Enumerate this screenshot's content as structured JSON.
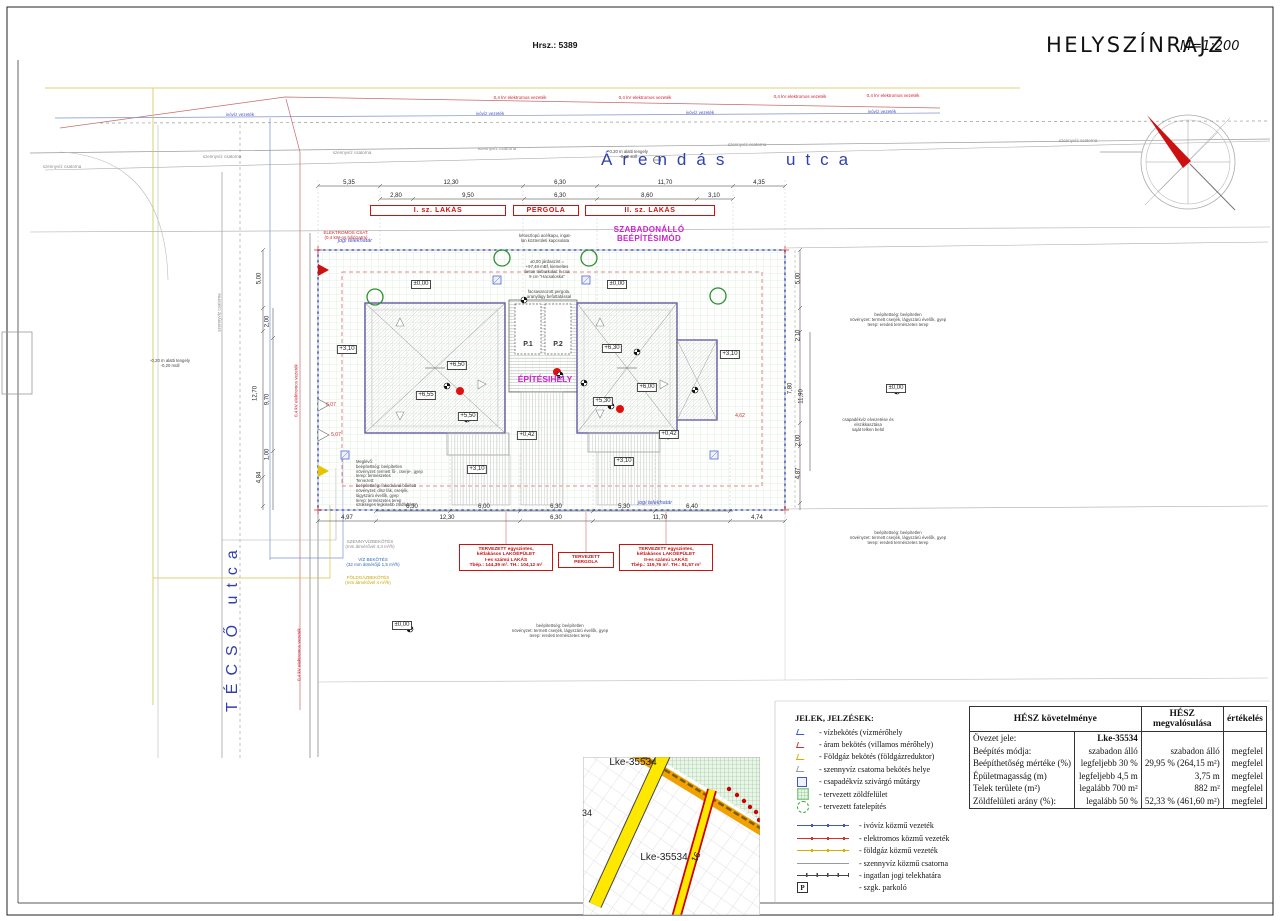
{
  "page": {
    "hrsz": "Hrsz.: 5389",
    "title": "HELYSZÍNRAJZ",
    "scale": "M=1:200"
  },
  "streets": {
    "top_a": "Árendás",
    "top_b": "utca",
    "left": "TÉCSŐ   utca"
  },
  "colors": {
    "red": "#cc2222",
    "magenta": "#cc22cc",
    "street_blue": "#3040ae",
    "boundary_blue": "#5c6cd0",
    "gas_yellow": "#d4af00",
    "green": "#2f8f2f"
  },
  "labels": [
    {
      "t": "5,35",
      "x": 349,
      "y": 180,
      "c": "d"
    },
    {
      "t": "12,30",
      "x": 451,
      "y": 180,
      "c": "d"
    },
    {
      "t": "6,30",
      "x": 560,
      "y": 180,
      "c": "d"
    },
    {
      "t": "11,70",
      "x": 665,
      "y": 180,
      "c": "d"
    },
    {
      "t": "4,35",
      "x": 759,
      "y": 180,
      "c": "d"
    },
    {
      "t": "2,80",
      "x": 396,
      "y": 193,
      "c": "d"
    },
    {
      "t": "9,50",
      "x": 468,
      "y": 193,
      "c": "d"
    },
    {
      "t": "6,30",
      "x": 560,
      "y": 193,
      "c": "d"
    },
    {
      "t": "8,60",
      "x": 647,
      "y": 193,
      "c": "d"
    },
    {
      "t": "3,10",
      "x": 714,
      "y": 193,
      "c": "d"
    },
    {
      "t": "6,30",
      "x": 412,
      "y": 504,
      "c": "d"
    },
    {
      "t": "6,00",
      "x": 484,
      "y": 504,
      "c": "d"
    },
    {
      "t": "6,30",
      "x": 556,
      "y": 504,
      "c": "d"
    },
    {
      "t": "5,30",
      "x": 624,
      "y": 504,
      "c": "d"
    },
    {
      "t": "6,40",
      "x": 692,
      "y": 504,
      "c": "d"
    },
    {
      "t": "4,97",
      "x": 347,
      "y": 515,
      "c": "d"
    },
    {
      "t": "12,30",
      "x": 447,
      "y": 515,
      "c": "d"
    },
    {
      "t": "6,30",
      "x": 556,
      "y": 515,
      "c": "d"
    },
    {
      "t": "11,70",
      "x": 660,
      "y": 515,
      "c": "d"
    },
    {
      "t": "4,74",
      "x": 757,
      "y": 515,
      "c": "d"
    },
    {
      "t": "5,00",
      "x": 260,
      "y": 275,
      "c": "dv",
      "r": -90
    },
    {
      "t": "2,00",
      "x": 268,
      "y": 318,
      "c": "dv",
      "r": -90
    },
    {
      "t": "12,70",
      "x": 256,
      "y": 390,
      "c": "dv",
      "r": -90
    },
    {
      "t": "9,70",
      "x": 268,
      "y": 396,
      "c": "dv",
      "r": -90
    },
    {
      "t": "1,00",
      "x": 268,
      "y": 451,
      "c": "dv",
      "r": -90
    },
    {
      "t": "4,84",
      "x": 260,
      "y": 474,
      "c": "dv",
      "r": -90
    },
    {
      "t": "5,00",
      "x": 799,
      "y": 275,
      "c": "dv",
      "r": -90
    },
    {
      "t": "2,10",
      "x": 799,
      "y": 332,
      "c": "dv",
      "r": -90
    },
    {
      "t": "7,80",
      "x": 791,
      "y": 385,
      "c": "dv",
      "r": -90
    },
    {
      "t": "11,90",
      "x": 802,
      "y": 393,
      "c": "dv",
      "r": -90
    },
    {
      "t": "2,00",
      "x": 799,
      "y": 437,
      "c": "dv",
      "r": -90
    },
    {
      "t": "4,87",
      "x": 799,
      "y": 470,
      "c": "dv",
      "r": -90
    },
    {
      "t": "6,07",
      "x": 331,
      "y": 403,
      "c": "dr"
    },
    {
      "t": "5,07",
      "x": 336,
      "y": 433,
      "c": "dr"
    },
    {
      "t": "4,62",
      "x": 740,
      "y": 414,
      "c": "dr"
    },
    {
      "t": "+3,10",
      "x": 347,
      "y": 345,
      "c": "e"
    },
    {
      "t": "±0,00",
      "x": 421,
      "y": 280,
      "c": "e"
    },
    {
      "t": "+6,50",
      "x": 457,
      "y": 361,
      "c": "e"
    },
    {
      "t": "+6,55",
      "x": 426,
      "y": 391,
      "c": "e"
    },
    {
      "t": "+5,50",
      "x": 468,
      "y": 412,
      "c": "e"
    },
    {
      "t": "+0,42",
      "x": 527,
      "y": 431,
      "c": "e"
    },
    {
      "t": "+3,10",
      "x": 477,
      "y": 465,
      "c": "e"
    },
    {
      "t": "±0,00",
      "x": 617,
      "y": 280,
      "c": "e"
    },
    {
      "t": "+6,30",
      "x": 612,
      "y": 344,
      "c": "e"
    },
    {
      "t": "+6,00",
      "x": 647,
      "y": 383,
      "c": "e"
    },
    {
      "t": "+5,30",
      "x": 603,
      "y": 397,
      "c": "e"
    },
    {
      "t": "+0,42",
      "x": 669,
      "y": 430,
      "c": "e"
    },
    {
      "t": "+3,10",
      "x": 624,
      "y": 457,
      "c": "e"
    },
    {
      "t": "+3,10",
      "x": 730,
      "y": 350,
      "c": "e"
    },
    {
      "t": "±0,00",
      "x": 896,
      "y": 384,
      "c": "e"
    },
    {
      "t": "±0,00",
      "x": 402,
      "y": 621,
      "c": "e"
    },
    {
      "t": "0,4 kV elektromos vezeték",
      "x": 520,
      "y": 95,
      "c": "ur"
    },
    {
      "t": "0,4 kV elektromos vezeték",
      "x": 645,
      "y": 95,
      "c": "ur"
    },
    {
      "t": "0,4 kV elektromos vezeték",
      "x": 800,
      "y": 94,
      "c": "ur"
    },
    {
      "t": "0,4 kV elektromos vezeték",
      "x": 893,
      "y": 93,
      "c": "ur"
    },
    {
      "t": "0,4 kV elektromos vezeték",
      "x": 296,
      "y": 388,
      "c": "ur",
      "r": -90
    },
    {
      "t": "0,4 kV elektromos vezeték",
      "x": 299,
      "y": 652,
      "c": "ur",
      "r": -90
    },
    {
      "t": "ivóvíz vezeték",
      "x": 240,
      "y": 112,
      "c": "ub"
    },
    {
      "t": "ivóvíz vezeték",
      "x": 490,
      "y": 111,
      "c": "ub"
    },
    {
      "t": "ivóvíz vezeték",
      "x": 700,
      "y": 110,
      "c": "ub"
    },
    {
      "t": "ivóvíz vezeték",
      "x": 882,
      "y": 109,
      "c": "ub"
    },
    {
      "t": "szennyvíz csatorna",
      "x": 62,
      "y": 164,
      "c": "ug"
    },
    {
      "t": "szennyvíz csatorna",
      "x": 222,
      "y": 154,
      "c": "ug"
    },
    {
      "t": "szennyvíz csatorna",
      "x": 352,
      "y": 150,
      "c": "ug"
    },
    {
      "t": "szennyvíz csatorna",
      "x": 497,
      "y": 146,
      "c": "ug"
    },
    {
      "t": "szennyvíz csatorna",
      "x": 747,
      "y": 142,
      "c": "ug"
    },
    {
      "t": "szennyvíz csatorna",
      "x": 1078,
      "y": 138,
      "c": "ug"
    },
    {
      "t": "szennyvíz csatorna",
      "x": 219,
      "y": 310,
      "c": "ug",
      "r": -90
    },
    {
      "t": "jogi telekhatár",
      "x": 355,
      "y": 238,
      "c": "j"
    },
    {
      "t": "jogi telekhatár",
      "x": 655,
      "y": 500,
      "c": "j"
    },
    {
      "t": "-0,20 m alatti tengely\n-0,20 süll",
      "x": 628,
      "y": 150,
      "c": "a"
    },
    {
      "t": "-0,20 m alatti tengely\n-0,20 müll",
      "x": 170,
      "y": 359,
      "c": "a"
    },
    {
      "t": "kétoszlopú acélkapu, ingat-\nlan közterületi kapcsolata",
      "x": 545,
      "y": 234,
      "c": "a"
    },
    {
      "t": "±0,00 járdaszint =\n+97,48 mBf, kiemeltes\nbeton térburkolat: h cca\n9 cm \"Hacsaloska\"",
      "x": 547,
      "y": 260,
      "c": "a"
    },
    {
      "t": "facsavarozott pergola,\naranylágy befuttatással",
      "x": 549,
      "y": 290,
      "c": "a"
    },
    {
      "t": "beépítettség: beépítetlen\nnövényzet: termett cserjék, lágyszárú évelők, gyep\nterep: eredeti természetes terep",
      "x": 898,
      "y": 313,
      "c": "a"
    },
    {
      "t": "csapadékvíz elvezetése és\nelszikkasztása\nsaját telken belül",
      "x": 868,
      "y": 418,
      "c": "a"
    },
    {
      "t": "beépítettség: beépítetlen\nnövényzet: termett cserjék, lágyszárú évelők, gyep\nterep: eredeti természetes terep",
      "x": 898,
      "y": 531,
      "c": "a"
    },
    {
      "t": "beépítettség: beépítetlen\nnövényzet: termett cserjék, lágyszárú évelők, gyep\nterep: eredeti természetes terep",
      "x": 560,
      "y": 624,
      "c": "a"
    },
    {
      "t": "Meglévő:\nbeépítettség: beépítetlen\nnövényzet: termett fű-, cserje-, gyep\nterep: természetes\nTervezett:\nbeépítettség: fakockával bővített\nnövényzet: dísz fák, cserjék,\nlágyszárú évelők, gyep\nterep: természetes terep\nszükséges legkisebb zöldfelület",
      "x": 356,
      "y": 460,
      "c": "aL"
    },
    {
      "t": "ELEKTROMOS CSAT.\n(0,4 kW-os hálózatra)",
      "x": 346,
      "y": 230,
      "c": "ra"
    },
    {
      "t": "SZENNYVÍZBEKÖTÉS\n(mm átmérővel 4,3 m³/h)",
      "x": 370,
      "y": 539,
      "c": "cg"
    },
    {
      "t": "VÍZ BEKÖTÉS\n(32 mm átmérőjű 1,5 m³/h)",
      "x": 373,
      "y": 557,
      "c": "cb"
    },
    {
      "t": "FÖLDGÁZBEKÖTÉS\n(mm átmérővel 4 m³/h)",
      "x": 368,
      "y": 575,
      "c": "cy"
    },
    {
      "t": "SZABADONÁLLÓ\nBEÉPÍTÉSIMÓD",
      "x": 649,
      "y": 225,
      "c": "m"
    },
    {
      "t": "ÉPÍTÉSIHELY",
      "x": 545,
      "y": 375,
      "c": "si"
    },
    {
      "t": "P.1",
      "x": 528,
      "y": 341,
      "c": "pk"
    },
    {
      "t": "P.2",
      "x": 558,
      "y": 341,
      "c": "pk"
    },
    {
      "t": "TERVEZETT egyszintes,\nkétlakásos LAKÓÉPÜLET\nI-es számú LAKÁS\nTbép.: 144,39 m². TH.: 104,12 m²",
      "x": 506,
      "y": 544,
      "c": "rb",
      "w": 88
    },
    {
      "t": "TERVEZETT\nPERGOLA",
      "x": 586,
      "y": 552,
      "c": "rb",
      "w": 50
    },
    {
      "t": "TERVEZETT egyszintes,\nkétlakásos LAKÓÉPÜLET\nII-es számú LAKÁS\nTbép.: 119,76 m². TH.: 91,57 m²",
      "x": 666,
      "y": 544,
      "c": "rb",
      "w": 88
    },
    {
      "t": "I. sz. LAKÁS",
      "x": 438,
      "y": 205,
      "c": "bn",
      "w": 134
    },
    {
      "t": "PERGOLA",
      "x": 546,
      "y": 205,
      "c": "bn",
      "w": 64
    },
    {
      "t": "II. sz. LAKÁS",
      "x": 650,
      "y": 205,
      "c": "bn",
      "w": 128
    },
    {
      "t": "Lke-35534",
      "x": 633,
      "y": 757,
      "c": "ins"
    },
    {
      "t": "Lke-35534",
      "x": 664,
      "y": 852,
      "c": "ins"
    },
    {
      "t": "34",
      "x": 587,
      "y": 808,
      "c": "insS"
    },
    {
      "t": "16",
      "x": 696,
      "y": 852,
      "c": "insS",
      "r": -62
    }
  ],
  "legend": {
    "title": "JELEK, JELZÉSEK:",
    "symbols": [
      {
        "s": "water",
        "t": "- vízbekötés (vízmérőhely"
      },
      {
        "s": "electric",
        "t": "- áram bekötés (villamos mérőhely)"
      },
      {
        "s": "gas",
        "t": "- Földgáz bekötés (földgázreduktor)"
      },
      {
        "s": "sewer",
        "t": "- szennyvíz csatorna bekötés helye"
      },
      {
        "s": "rain",
        "t": "- csapadékvíz szivárgó műtárgy"
      },
      {
        "s": "green",
        "t": "- tervezett zöldfelület"
      },
      {
        "s": "tree",
        "t": "- tervezett fatelepítés"
      }
    ],
    "lines": [
      {
        "s": "line-water",
        "t": "- ivóvíz közmű vezeték"
      },
      {
        "s": "line-electric",
        "t": "- elektromos közmű vezeték"
      },
      {
        "s": "line-gas",
        "t": "- földgáz közmű vezeték"
      },
      {
        "s": "line-sewer",
        "t": "- szennyvíz közmű csatorna"
      },
      {
        "s": "line-boundary",
        "t": "- ingatlan jogi telekhatára"
      },
      {
        "s": "parking",
        "p": "P",
        "t": "- szgk. parkoló"
      }
    ]
  },
  "hesz": {
    "h1": "HÉSZ követelménye",
    "h2": "HÉSZ megvalósulása",
    "h3": "értékelés",
    "rows": [
      [
        "Övezet jele:",
        "Lke-35534",
        "",
        ""
      ],
      [
        "Beépítés módja:",
        "szabadon álló",
        "szabadon álló",
        "megfelel"
      ],
      [
        "Beépíthetőség mértéke (%)",
        "legfeljebb 30 %",
        "29,95 % (264,15 m²)",
        "megfelel"
      ],
      [
        "Épületmagasság (m)",
        "legfeljebb 4,5 m",
        "3,75 m",
        "megfelel"
      ],
      [
        "Telek területe (m²)",
        "legalább 700 m²",
        "882 m²",
        "megfelel"
      ],
      [
        "Zöldfelületi arány (%):",
        "legalább 50 %",
        "52,33 % (461,60 m²)",
        "megfelel"
      ]
    ]
  }
}
